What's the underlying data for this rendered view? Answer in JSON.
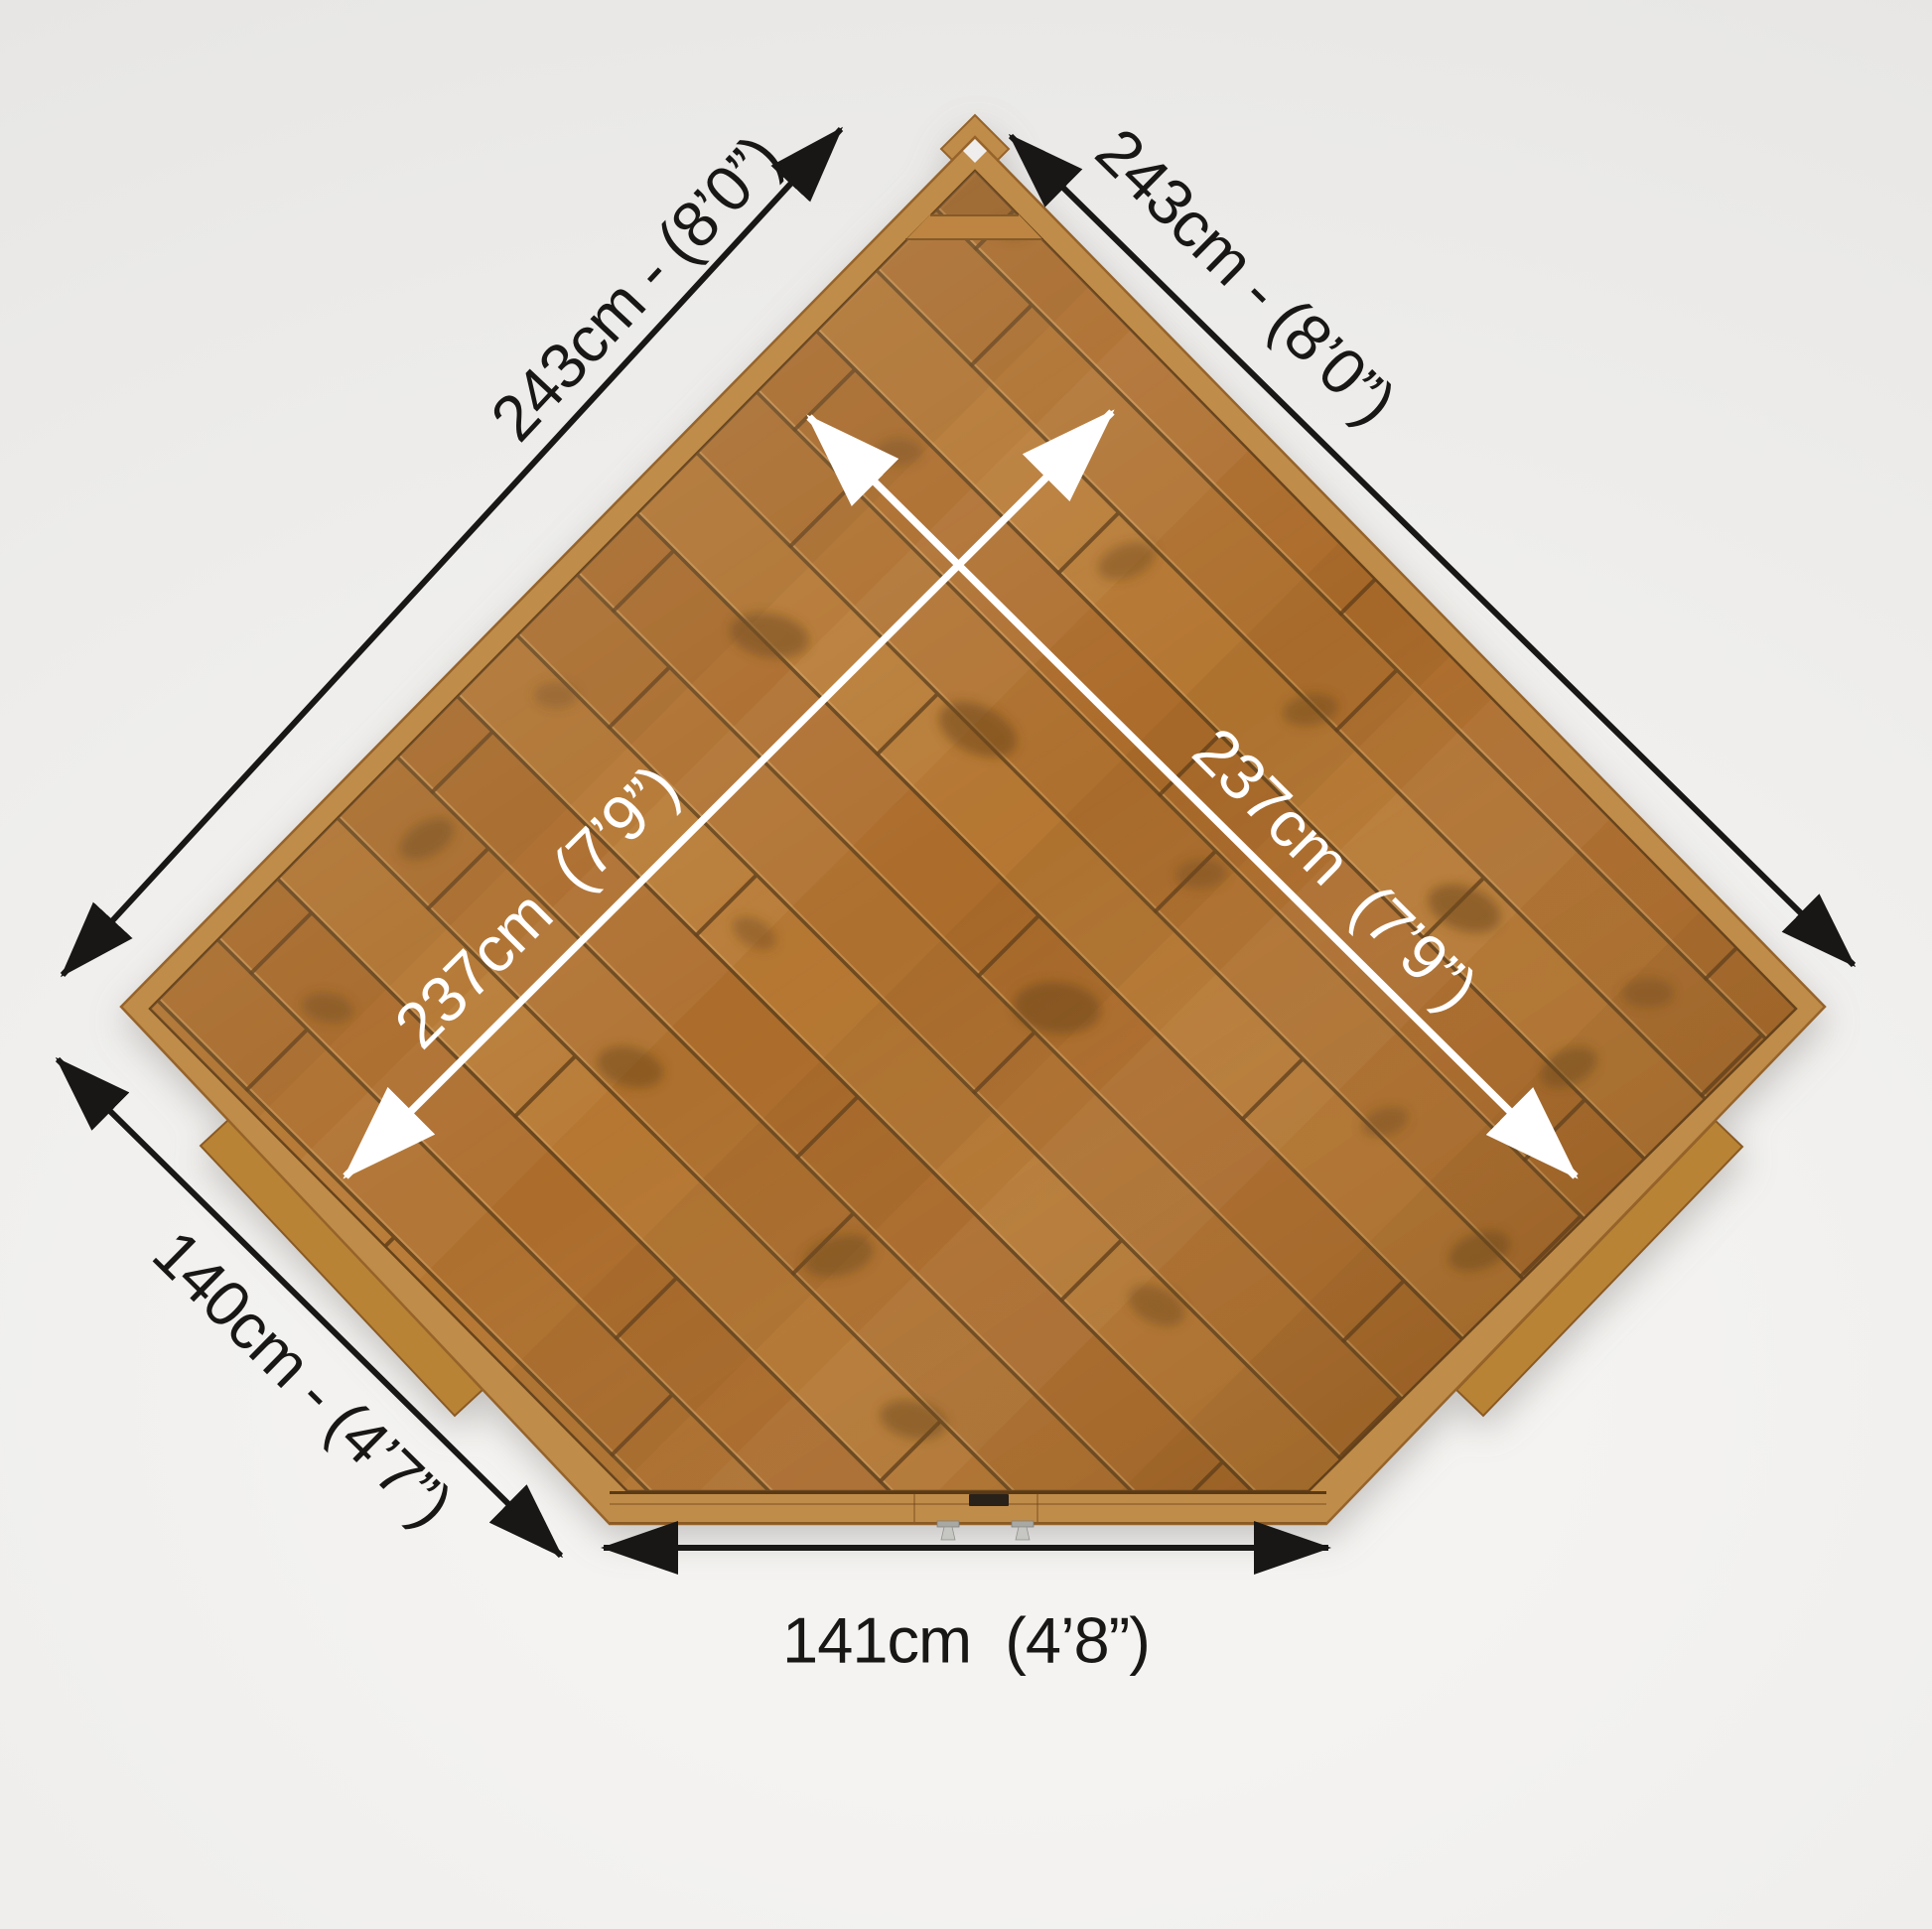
{
  "diagram": {
    "image_type": "product dimension diagram",
    "subject": "corner shed wooden floor, top-down view",
    "colors": {
      "background": "#efeeec",
      "plank_wood": "#b0702c",
      "trim_wood": "#c08c49",
      "outer_arrows": "#181715",
      "inner_arrows": "#ffffff"
    },
    "dimensions": {
      "top_left_edge": {
        "label": "243cm - (8’0”)"
      },
      "top_right_edge": {
        "label": "243cm - (8’0”)"
      },
      "inner_left": {
        "label": "237cm  (7’9”)"
      },
      "inner_right": {
        "label": "237cm  (7’9”)"
      },
      "left_side_edge": {
        "label": "140cm - (4’7”)"
      },
      "front_edge": {
        "label": "141cm  (4’8”)"
      }
    },
    "hardware": [
      "door-lock-plate",
      "door-hinge",
      "door-hinge"
    ]
  }
}
